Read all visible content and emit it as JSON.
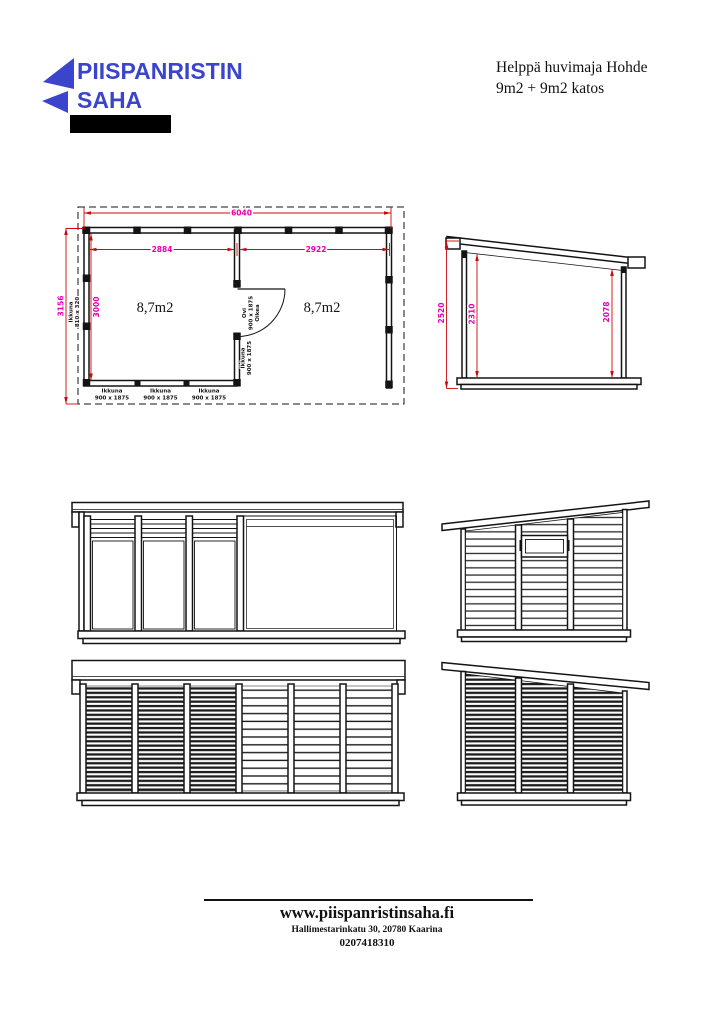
{
  "logo": {
    "line1": "PIISPANRISTIN",
    "line2": "SAHA"
  },
  "title": {
    "line1": "Helppä huvimaja Hohde",
    "line2": "9m2 + 9m2 katos"
  },
  "floor_plan": {
    "overall_width": "6040",
    "left_room_width": "2884",
    "right_room_width": "2922",
    "overall_depth": "3156",
    "room_depth": "3000",
    "left_area": "8,7m2",
    "right_area": "8,7m2",
    "side_window": {
      "word": "Ikkuna",
      "size": "810 x 320"
    },
    "door": {
      "word": "Ovi",
      "size": "900 x 1875",
      "hand": "Oikea"
    },
    "mid_window": {
      "word": "Ikkuna",
      "size": "900 x 1875"
    },
    "front_windows": [
      {
        "word": "Ikkuna",
        "size": "900 x 1875"
      },
      {
        "word": "Ikkuna",
        "size": "900 x 1875"
      },
      {
        "word": "Ikkuna",
        "size": "900 x 1875"
      }
    ]
  },
  "side_section": {
    "front_height": "2520",
    "inner_front_height": "2310",
    "inner_back_height": "2078"
  },
  "footer": {
    "website": "www.piispanristinsaha.fi",
    "address": "Hallimestarinkatu 30, 20780 Kaarina",
    "phone": "0207418310"
  },
  "colors": {
    "logo_blue": "#3b44cd",
    "dimension_line_red": "#cd0a0a",
    "dimension_text_magenta": "#e800b0",
    "ink": "#141414"
  }
}
